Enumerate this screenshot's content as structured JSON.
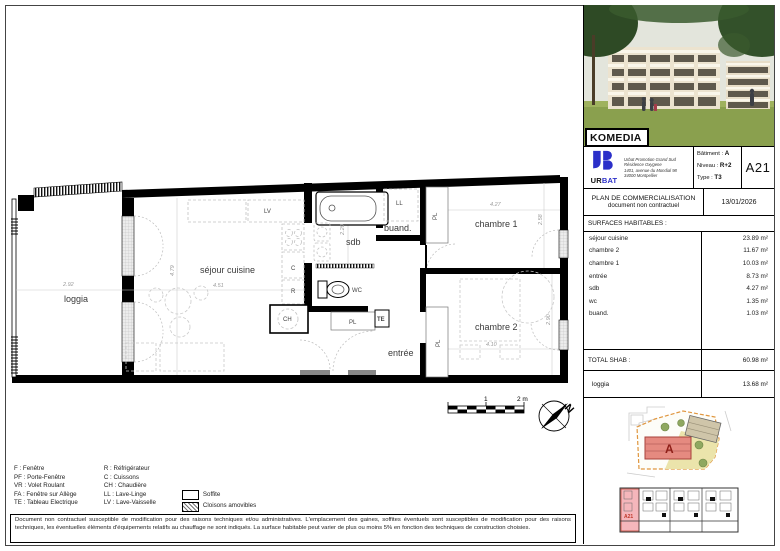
{
  "sidebar": {
    "project_name": "KOMEDIA",
    "developer": {
      "brand_ur": "UR",
      "brand_bat": "BAT",
      "address_line1": "Urbat Promotion Grand Sud",
      "address_line2": "Résidence Oxygene",
      "address_line3": "1401, avenue du Mondial 98",
      "address_line4": "34000 Montpellier"
    },
    "unit": {
      "batiment_label": "Bâtiment :",
      "batiment": "A",
      "niveau_label": "Niveau :",
      "niveau": "R+2",
      "type_label": "Type :",
      "type": "T3",
      "lot": "A21"
    },
    "doc": {
      "title": "PLAN DE COMMERCIALISATION",
      "subtitle": "document non contractuel",
      "date": "13/01/2026"
    },
    "surfaces": {
      "heading": "SURFACES HABITABLES :",
      "rows": [
        {
          "label": "séjour cuisine",
          "value": "23.89 m²"
        },
        {
          "label": "chambre 2",
          "value": "11.67 m²"
        },
        {
          "label": "chambre 1",
          "value": "10.03 m²"
        },
        {
          "label": "entrée",
          "value": "8.73 m²"
        },
        {
          "label": "sdb",
          "value": "4.27 m²"
        },
        {
          "label": "wc",
          "value": "1.35 m²"
        },
        {
          "label": "buand.",
          "value": "1.03 m²"
        }
      ],
      "total_label": "TOTAL SHAB :",
      "total_value": "60.98 m²",
      "loggia_label": "loggia",
      "loggia_value": "13.68 m²"
    },
    "site_plan": {
      "building_label": "A"
    },
    "key_plan": {
      "unit_label": "A21"
    }
  },
  "floor_plan": {
    "rooms": {
      "loggia": "loggia",
      "sejour": "séjour cuisine",
      "sdb": "sdb",
      "buand": "buand.",
      "wc": "WC",
      "entree": "entrée",
      "chambre1": "chambre 1",
      "chambre2": "chambre 2"
    },
    "labels": {
      "lv": "LV",
      "ll": "LL",
      "c": "C",
      "r": "R",
      "ch": "CH",
      "te": "TE",
      "pl": "PL"
    },
    "dims": {
      "loggia_w": "2.92",
      "sejour_w": "4.51",
      "sejour_h": "4.79",
      "sdb_h": "2.20",
      "chambre1_w": "4.27",
      "chambre1_h": "2.58",
      "chambre2_w": "4.10",
      "chambre2_h": "2.90"
    },
    "scale_bar": {
      "mid": "1",
      "end": "2 m"
    },
    "compass": "N"
  },
  "legend": {
    "col1": [
      "F : Fenêtre",
      "PF : Porte-Fenêtre",
      "VR : Volet Roulant",
      "FA : Fenêtre sur Allège",
      "TE : Tableau Electrique"
    ],
    "col2": [
      "R : Réfrigérateur",
      "C : Cuissons",
      "CH : Chaudière",
      "LL : Lave-Linge",
      "LV : Lave-Vaisselle"
    ],
    "soffite": "Soffite",
    "cloisons": "Cloisons amovibles"
  },
  "disclaimer": "Document non contractuel susceptible de modification pour des raisons techniques et/ou administratives. L'emplacement des gaines, soffites éventuels sont susceptibles de modification pour des raisons techniques, les éventuelles éléments d'équipements relatifs au chauffage ne sont indiqués. La surface habitable peut varier de plus ou moins 5% en fonction des techniques de construction choisies."
}
